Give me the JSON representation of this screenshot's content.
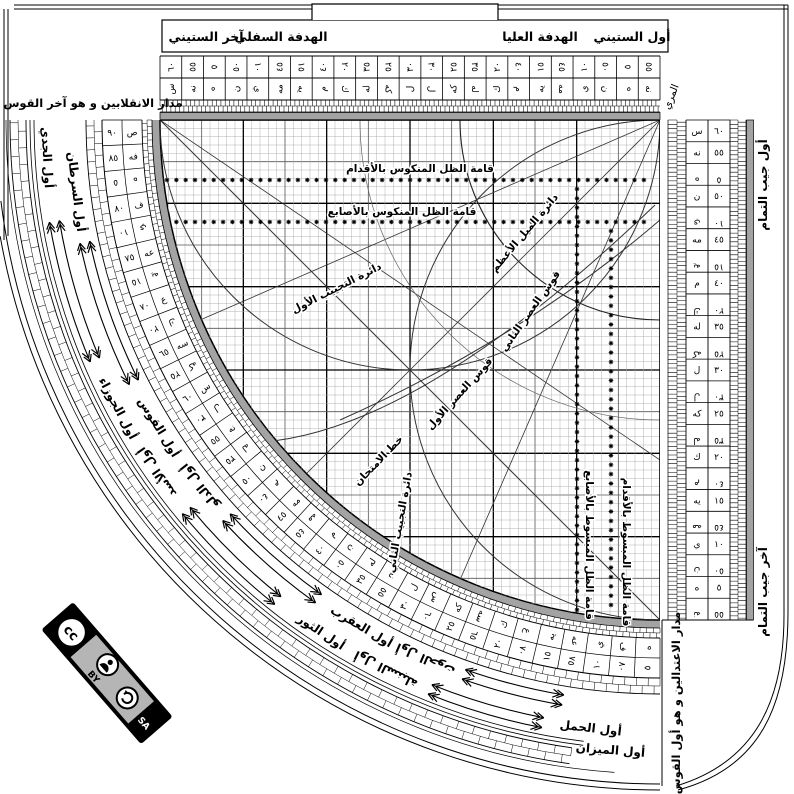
{
  "top_bar": {
    "awwal_sittini": "أول الستيني",
    "hadafa_ulya": "الهدفة العليا",
    "hadafa_sufla": "الهدفة السفلي",
    "akhir_sittini": "آخر الستيني"
  },
  "corner_labels": {
    "top_left": "مدار الانقلابين و هو آخر القوس",
    "bottom_right": "مدار الاعتدالين و هو أول القوس",
    "muri": "المري",
    "cos_start": "أول جيب التمام",
    "cos_end": "آخر جيب التمام"
  },
  "dual_scale": [
    {
      "n": "٦٠",
      "a": "س",
      "f": false
    },
    {
      "n": "٥٥",
      "a": "نه",
      "f": false
    },
    {
      "n": "٥",
      "a": "ه",
      "f": true
    },
    {
      "n": "٥٠",
      "a": "ن",
      "f": false
    },
    {
      "n": "١٠",
      "a": "ي",
      "f": true
    },
    {
      "n": "٤٥",
      "a": "مه",
      "f": false
    },
    {
      "n": "١٥",
      "a": "يه",
      "f": true
    },
    {
      "n": "٤٠",
      "a": "م",
      "f": false
    },
    {
      "n": "٢٠",
      "a": "ك",
      "f": true
    },
    {
      "n": "٣٥",
      "a": "له",
      "f": false
    },
    {
      "n": "٢٥",
      "a": "كه",
      "f": true
    },
    {
      "n": "٣٠",
      "a": "ل",
      "f": false
    },
    {
      "n": "٣٠",
      "a": "ل",
      "f": true
    },
    {
      "n": "٢٥",
      "a": "كه",
      "f": false
    },
    {
      "n": "٣٥",
      "a": "له",
      "f": true
    },
    {
      "n": "٢٠",
      "a": "ك",
      "f": false
    },
    {
      "n": "٤٠",
      "a": "م",
      "f": true
    },
    {
      "n": "١٥",
      "a": "يه",
      "f": false
    },
    {
      "n": "٤٥",
      "a": "مه",
      "f": true
    },
    {
      "n": "١٠",
      "a": "ي",
      "f": false
    },
    {
      "n": "٥٠",
      "a": "ن",
      "f": true
    },
    {
      "n": "٥",
      "a": "ه",
      "f": false
    },
    {
      "n": "٥٥",
      "a": "نه",
      "f": true
    }
  ],
  "arc_scale": [
    {
      "n": "٩٠",
      "a": "ص",
      "f": false
    },
    {
      "n": "٨٥",
      "a": "فه",
      "f": false
    },
    {
      "n": "٥",
      "a": "ه",
      "f": true
    },
    {
      "n": "٨٠",
      "a": "ف",
      "f": false
    },
    {
      "n": "١٠",
      "a": "ي",
      "f": true
    },
    {
      "n": "٧٥",
      "a": "عه",
      "f": false
    },
    {
      "n": "١٥",
      "a": "يه",
      "f": true
    },
    {
      "n": "٧٠",
      "a": "ع",
      "f": false
    },
    {
      "n": "٢٠",
      "a": "ك",
      "f": true
    },
    {
      "n": "٦٥",
      "a": "سه",
      "f": false
    },
    {
      "n": "٢٥",
      "a": "كه",
      "f": true
    },
    {
      "n": "٦٠",
      "a": "س",
      "f": false
    },
    {
      "n": "٣٠",
      "a": "ل",
      "f": true
    },
    {
      "n": "٥٥",
      "a": "نه",
      "f": false
    },
    {
      "n": "٣٥",
      "a": "له",
      "f": true
    },
    {
      "n": "٥٠",
      "a": "ن",
      "f": false
    },
    {
      "n": "٤٠",
      "a": "م",
      "f": true
    },
    {
      "n": "٤٥",
      "a": "مه",
      "f": false
    },
    {
      "n": "٤٥",
      "a": "مه",
      "f": true
    },
    {
      "n": "٤٠",
      "a": "م",
      "f": false
    },
    {
      "n": "٥٠",
      "a": "ن",
      "f": true
    },
    {
      "n": "٣٥",
      "a": "له",
      "f": false
    },
    {
      "n": "٥٥",
      "a": "نه",
      "f": true
    },
    {
      "n": "٣٠",
      "a": "ل",
      "f": false
    },
    {
      "n": "٦٠",
      "a": "س",
      "f": true
    },
    {
      "n": "٢٥",
      "a": "كه",
      "f": false
    },
    {
      "n": "٦٥",
      "a": "سه",
      "f": true
    },
    {
      "n": "٢٠",
      "a": "ك",
      "f": false
    },
    {
      "n": "٧٠",
      "a": "ع",
      "f": true
    },
    {
      "n": "١٥",
      "a": "يه",
      "f": false
    },
    {
      "n": "٧٥",
      "a": "عه",
      "f": true
    },
    {
      "n": "١٠",
      "a": "ي",
      "f": false
    },
    {
      "n": "٨٠",
      "a": "ف",
      "f": true
    },
    {
      "n": "٥",
      "a": "ه",
      "f": false
    }
  ],
  "grid_labels": [
    {
      "text": "قامة الظل المنكوس بالأقدام",
      "x": 420,
      "y": 172,
      "rot": 0
    },
    {
      "text": "قامة الظل المنكوس بالأصابع",
      "x": 402,
      "y": 215,
      "rot": 0
    },
    {
      "text": "دائرة الميل الأعظم",
      "x": 527,
      "y": 235,
      "rot": -50
    },
    {
      "text": "قوس العصر الثاني",
      "x": 533,
      "y": 313,
      "rot": -55
    },
    {
      "text": "قوس العصر الأول",
      "x": 462,
      "y": 396,
      "rot": -48
    },
    {
      "text": "دائرة التجييب الأول",
      "x": 338,
      "y": 291,
      "rot": -27
    },
    {
      "text": "خط الامتحان",
      "x": 381,
      "y": 463,
      "rot": -46
    },
    {
      "text": "دائرة التجييب الثاني",
      "x": 403,
      "y": 523,
      "rot": -80
    },
    {
      "text": "قامة الظل المبسوط بالأصابع",
      "x": 586,
      "y": 545,
      "rot": 90
    },
    {
      "text": "قامة الظل المبسوط بالأقدام",
      "x": 623,
      "y": 552,
      "rot": 90
    }
  ],
  "zodiac": {
    "outer_radius": 614,
    "inner_radius": 588,
    "outer": [
      {
        "t": "أول الجدي",
        "phi": 86.5,
        "flip": false
      },
      {
        "t": "أول الجوزاء",
        "phi": 62,
        "flip": false
      },
      {
        "t": "أول الأسد",
        "phi": 55,
        "flip": true
      },
      {
        "t": "أول الثور",
        "phi": 33.5,
        "flip": false
      },
      {
        "t": "أول السنبلة",
        "phi": 26.5,
        "flip": true
      },
      {
        "t": "أول الحمل",
        "phi": 6.5,
        "flip": false,
        "r": 612
      }
    ],
    "inner": [
      {
        "t": "أول السرطان",
        "phi": 83,
        "flip": false
      },
      {
        "t": "أول القوس",
        "phi": 58.5,
        "flip": false
      },
      {
        "t": "أول الدلو",
        "phi": 51.5,
        "flip": true
      },
      {
        "t": "أول العقرب",
        "phi": 30.5,
        "flip": false
      },
      {
        "t": "أول الحوت",
        "phi": 23.5,
        "flip": true
      },
      {
        "t": "أول الميزان",
        "phi": 4.5,
        "flip": false,
        "r": 632
      }
    ],
    "arrow_spans_outer": [
      [
        80.5,
        67
      ],
      [
        50.5,
        38.5
      ],
      [
        22,
        11
      ]
    ],
    "arrow_spans_inner": [
      [
        78,
        63.5
      ],
      [
        47.5,
        35.5
      ],
      [
        19.5,
        9.5
      ]
    ]
  },
  "cc_badge": {
    "cc": "cc",
    "by": "BY",
    "sa": "SA"
  },
  "colors": {
    "ink": "#000000",
    "gray_band": "#a3a3a3",
    "panel_gray": "#b5b5b5",
    "grid_minor": "#aaaaaa",
    "grid_mid": "#555555",
    "curve": "#333333"
  }
}
